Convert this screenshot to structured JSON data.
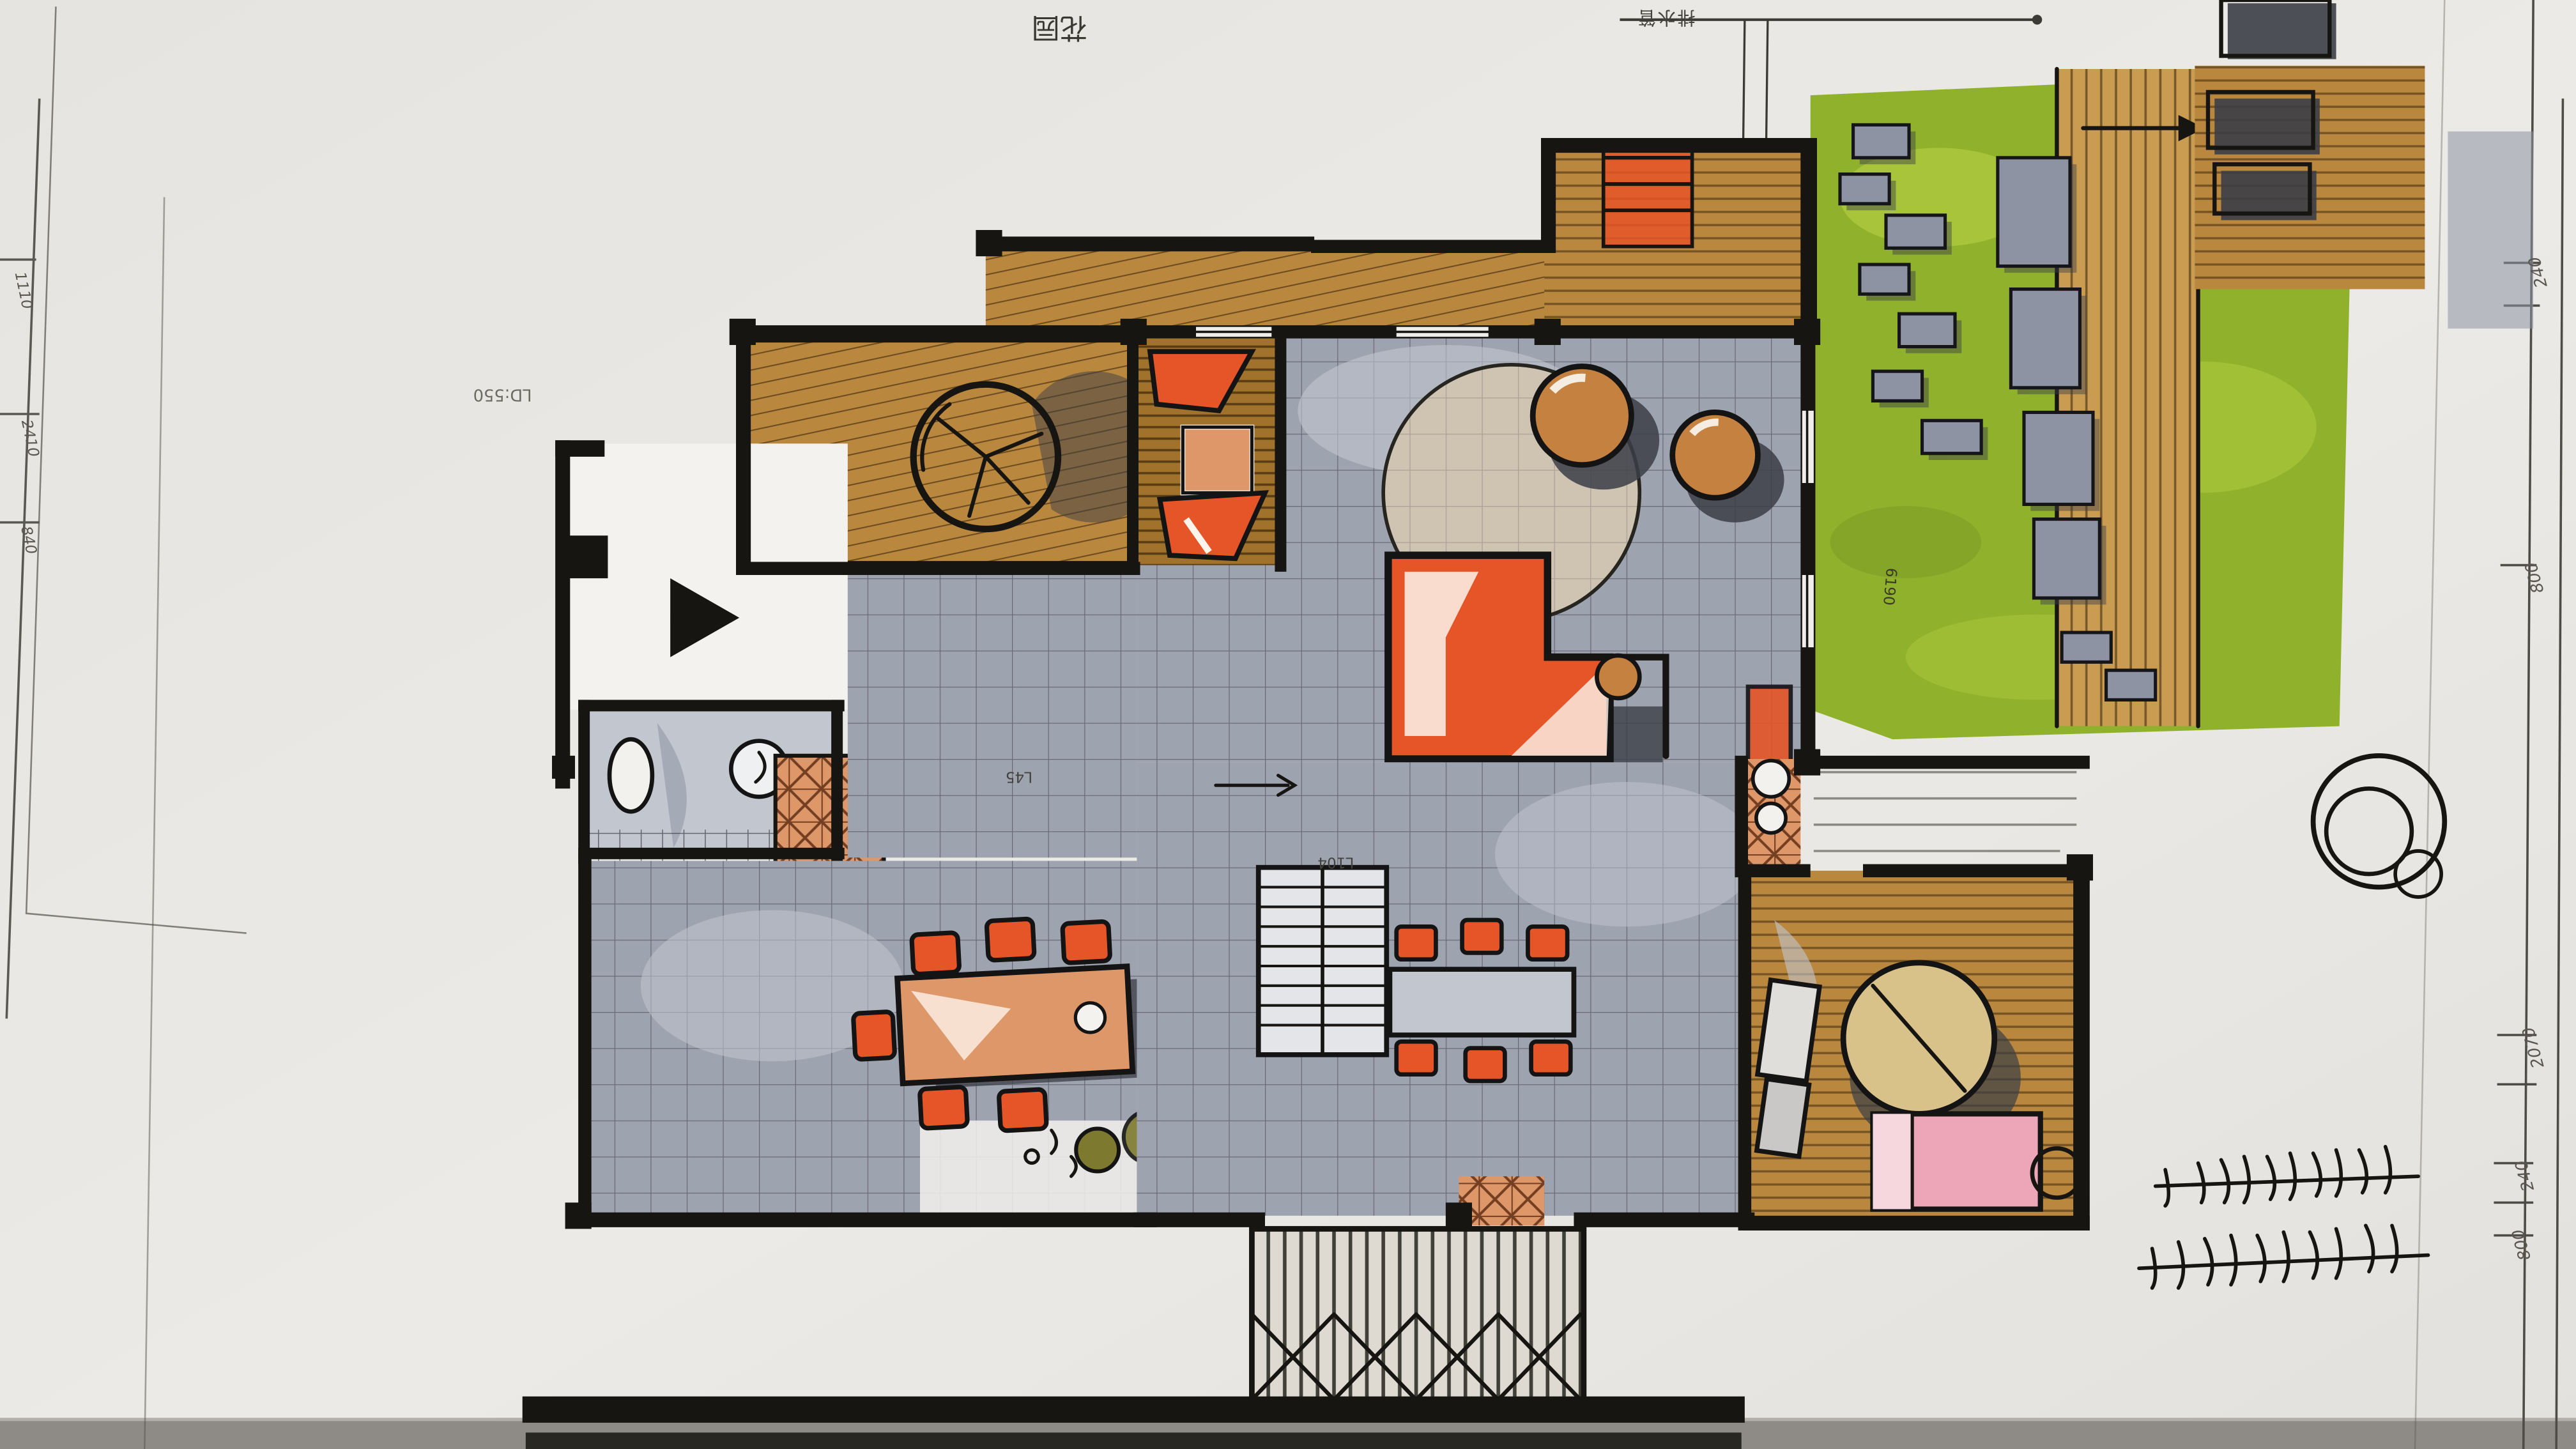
{
  "labels": {
    "garden_title": "花园",
    "drain_note": "排水管",
    "ld_note": "LD:550",
    "level_note_1": "L45",
    "level_note_2": "L104",
    "lawn_dim": "6190"
  },
  "dimensions": {
    "right": [
      "240",
      "800",
      "2070",
      "240",
      "800"
    ],
    "left": [
      "1110",
      "2410",
      "840"
    ]
  },
  "colors": {
    "paper": "#e9e7e3",
    "paper-edge": "#8e8b87",
    "ink": "#161511",
    "floor-gray": "#9ea3b0",
    "floor-gray-light": "#c2c6cf",
    "wood": "#b9873e",
    "wood-dark": "#a0722c",
    "wood-light": "#c99c52",
    "orange": "#e65527",
    "salmon": "#de9769",
    "tan": "#c4813f",
    "lawn": "#8fb12c",
    "lawn-light": "#aec93e",
    "olive": "#7d7a2f",
    "charcoal": "#3b3e46",
    "stone": "#8d93a3",
    "pink": "#eda6b8",
    "beige": "#d9c28a",
    "rug": "#cfc3b2"
  }
}
